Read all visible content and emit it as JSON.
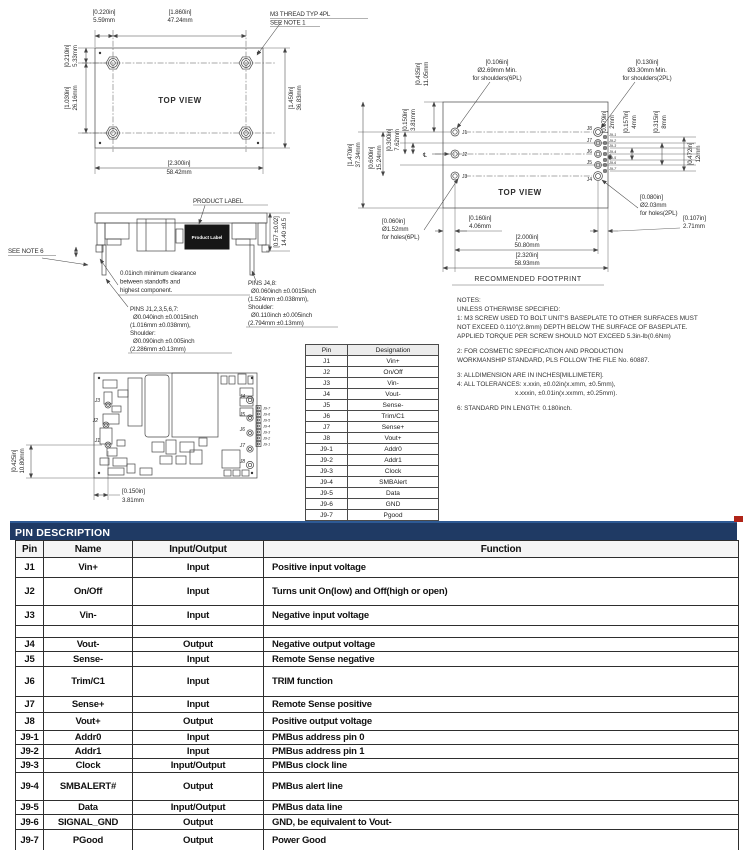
{
  "tv": {
    "title": "TOP VIEW",
    "callout1": "M3 THREAD TYP 4PL",
    "callout2": "SEE NOTE 1",
    "t1_in": "[0.220in]",
    "t1_mm": "5.59mm",
    "t2_in": "[1.860in]",
    "t2_mm": "47.24mm",
    "t3_in": "[0.210in]",
    "t3_mm": "5.33mm",
    "t4_in": "[1.030in]",
    "t4_mm": "26.16mm",
    "t5_in": "[1.450in]",
    "t5_mm": "36.83mm",
    "t6_in": "[2.300in]",
    "t6_mm": "58.42mm"
  },
  "sv": {
    "product_label_callout": "PRODUCT LABEL",
    "product_label_text": "Product Label",
    "see_note": "SEE NOTE 6",
    "h_in": "[0.57 ±0.02]",
    "h_mm": "14.40 ±0.5",
    "clr1": "0.01inch minimum clearance",
    "clr2": "between standoffs and",
    "clr3": "highest component.",
    "pa1": "PINS J1,2,3,5,6,7:",
    "pa2": "Ø0.040inch ±0.0015inch",
    "pa3": "(1.016mm ±0.038mm),",
    "pa4": "Shoulder:",
    "pa5": "Ø0.090inch ±0.005inch",
    "pa6": "(2.286mm ±0.13mm)",
    "pb1": "PINS J4,8:",
    "pb2": "Ø0.060inch ±0.0015inch",
    "pb3": "(1.524mm ±0.038mm),",
    "pb4": "Shoulder:",
    "pb5": "Ø0.110inch ±0.005inch",
    "pb6": "(2.794mm ±0.13mm)"
  },
  "bv": {
    "v_in": "[0.425in]",
    "v_mm": "10.80mm",
    "h_in": "[0.150in]",
    "h_mm": "3.81mm",
    "labels_left": [
      "J3",
      "J2",
      "J1"
    ],
    "labels_right": [
      "J4",
      "J5",
      "J6",
      "J7",
      "J8"
    ],
    "labels_j9": [
      "J9-7",
      "J9-6",
      "J9-5",
      "J9-4",
      "J9-3",
      "J9-2",
      "J9-1"
    ]
  },
  "fp": {
    "title": "TOP VIEW",
    "caption": "RECOMMENDED FOOTPRINT",
    "centerline": "℄",
    "sh6_1": "[0.106in]",
    "sh6_2": "Ø2.69mm Min.",
    "sh6_3": "for shoulders(6PL)",
    "sh2_1": "[0.130in]",
    "sh2_2": "Ø3.30mm Min.",
    "sh2_3": "for shoulders(2PL)",
    "ho6_1": "[0.060in]",
    "ho6_2": "Ø1.52mm",
    "ho6_3": "for holes(6PL)",
    "ho2_1": "[0.080in]",
    "ho2_2": "Ø2.03mm",
    "ho2_3": "for holes(2PL)",
    "d0435_in": "[0.435in]",
    "d0435_mm": "11.05mm",
    "d1470_in": "[1.470in]",
    "d1470_mm": "37.34mm",
    "d0600_in": "[0.600in]",
    "d0600_mm": "15.24mm",
    "d0300_in": "[0.300in]",
    "d0300_mm": "7.62mm",
    "d0150_in": "[0.150in]",
    "d0150_mm": "3.81mm",
    "d0079_in": "[0.079in]",
    "d0079_mm": "2mm",
    "d0157_in": "[0.157in]",
    "d0157_mm": "4mm",
    "d0315_in": "[0.315in]",
    "d0315_mm": "8mm",
    "d0472_in": "[0.472in]",
    "d0472_mm": "12mm",
    "d0160_in": "[0.160in]",
    "d0160_mm": "4.06mm",
    "d2000_in": "[2.000in]",
    "d2000_mm": "50.80mm",
    "d2320_in": "[2.320in]",
    "d2320_mm": "58.93mm",
    "d0107_in": "[0.107in]",
    "d0107_mm": "2.71mm",
    "labels_left": [
      "J1",
      "J2",
      "J3"
    ],
    "labels_right": [
      "J8",
      "J7",
      "J6",
      "J5",
      "J4"
    ],
    "labels_j9": [
      "J9-1",
      "J9-2",
      "J9-3",
      "J9-4",
      "J9-5",
      "J9-6",
      "J9-7"
    ]
  },
  "notes": {
    "lines": [
      "NOTES:",
      "UNLESS OTHERWISE SPECIFIED:",
      "1: M3 SCREW USED TO BOLT UNIT'S BASEPLATE TO OTHER SURFACES MUST",
      "NOT EXCEED 0.110\"(2.8mm) DEPTH BELOW THE SURFACE OF BASEPLATE.",
      "APPLIED TORQUE PER SCREW SHOULD NOT EXCEED 5.3in-lb(0.6Nm)",
      "",
      "2: FOR COSMETIC SPECIFICATION AND PRODUCTION",
      "WORKMANSHIP STANDARD, PLS FOLLOW THE FILE No. 60887.",
      "",
      "3: ALLDIMENSION ARE IN INCHES[MILLIMETER].",
      "4: ALL TOLERANCES: x.xxin, ±0.02in(x.xmm, ±0.5mm),",
      "x.xxxin, ±0.01in(x.xxmm, ±0.25mm).",
      "",
      "6: STANDARD PIN LENGTH: 0.180inch."
    ]
  },
  "designation_table": {
    "headers": [
      "Pin",
      "Designation"
    ],
    "rows": [
      [
        "J1",
        "Vin+"
      ],
      [
        "J2",
        "On/Off"
      ],
      [
        "J3",
        "Vin-"
      ],
      [
        "J4",
        "Vout-"
      ],
      [
        "J5",
        "Sense-"
      ],
      [
        "J6",
        "Trim/C1"
      ],
      [
        "J7",
        "Sense+"
      ],
      [
        "J8",
        "Vout+"
      ],
      [
        "J9-1",
        "Addr0"
      ],
      [
        "J9-2",
        "Addr1"
      ],
      [
        "J9-3",
        "Clock"
      ],
      [
        "J9-4",
        "SMBAlert"
      ],
      [
        "J9-5",
        "Data"
      ],
      [
        "J9-6",
        "GND"
      ],
      [
        "J9-7",
        "Pgood"
      ]
    ]
  },
  "pin_description": {
    "bar_title": "PIN DESCRIPTION",
    "headers": [
      "Pin",
      "Name",
      "Input/Output",
      "Function"
    ],
    "rows": [
      {
        "pin": "J1",
        "name": "Vin+",
        "io": "Input",
        "fn": "Positive input voltage"
      },
      {
        "pin": "J2",
        "name": "On/Off",
        "io": "Input",
        "fn": "Turns unit On(low) and Off(high or open)"
      },
      {
        "pin": "J3",
        "name": "Vin-",
        "io": "Input",
        "fn": "Negative input voltage"
      },
      {
        "pin": "",
        "name": "",
        "io": "",
        "fn": ""
      },
      {
        "pin": "J4",
        "name": "Vout-",
        "io": "Output",
        "fn": "Negative output voltage"
      },
      {
        "pin": "J5",
        "name": "Sense-",
        "io": "Input",
        "fn": "Remote Sense negative"
      },
      {
        "pin": "J6",
        "name": "Trim/C1",
        "io": "Input",
        "fn": "TRIM function"
      },
      {
        "pin": "J7",
        "name": "Sense+",
        "io": "Input",
        "fn": "Remote Sense positive"
      },
      {
        "pin": "J8",
        "name": "Vout+",
        "io": "Output",
        "fn": "Positive output voltage"
      },
      {
        "pin": "J9-1",
        "name": "Addr0",
        "io": "Input",
        "fn": "PMBus address pin 0"
      },
      {
        "pin": "J9-2",
        "name": "Addr1",
        "io": "Input",
        "fn": "PMBus address pin 1"
      },
      {
        "pin": "J9-3",
        "name": "Clock",
        "io": "Input/Output",
        "fn": "PMBus clock line"
      },
      {
        "pin": "J9-4",
        "name": "SMBALERT#",
        "io": "Output",
        "fn": "PMBus alert line"
      },
      {
        "pin": "J9-5",
        "name": "Data",
        "io": "Input/Output",
        "fn": "PMBus data line"
      },
      {
        "pin": "J9-6",
        "name": "SIGNAL_GND",
        "io": "Output",
        "fn": "GND, be equivalent to Vout-"
      },
      {
        "pin": "J9-7",
        "name": "PGood",
        "io": "Output",
        "fn": "Power Good"
      }
    ]
  }
}
